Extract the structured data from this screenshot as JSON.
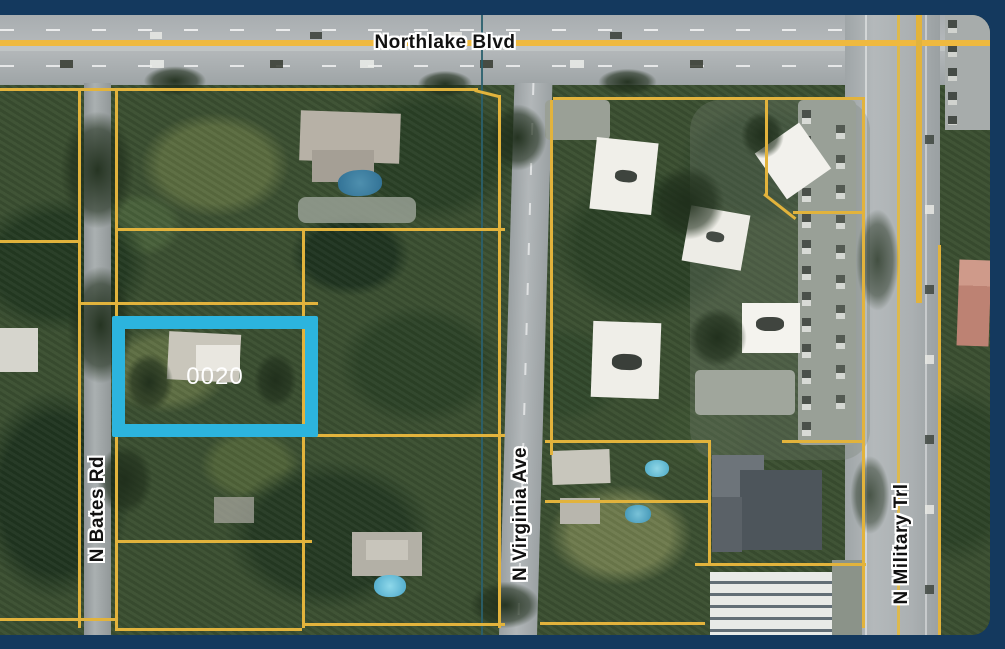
{
  "map": {
    "type": "aerial-parcel-map",
    "selected_parcel": {
      "label": "0020"
    },
    "streets": [
      {
        "name": "Northlake Blvd",
        "orientation": "horizontal"
      },
      {
        "name": "N Bates Rd",
        "orientation": "vertical"
      },
      {
        "name": "N Virginia Ave",
        "orientation": "vertical"
      },
      {
        "name": "N Military Trl",
        "orientation": "vertical"
      }
    ],
    "colors": {
      "frame": "#14395E",
      "parcel_boundary": "#E2B33C",
      "selected_parcel_outline": "#2CB4DE",
      "parcel_label_text": "#FFFFFF",
      "street_label_text": "#111111",
      "street_label_halo": "#FFFFFF",
      "municipal_boundary": "#2A5F6D"
    }
  }
}
